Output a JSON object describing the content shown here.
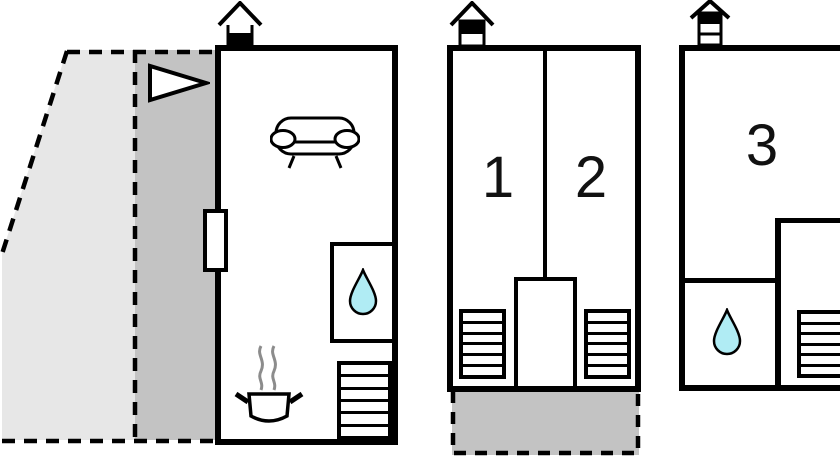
{
  "floor_plan": {
    "room_labels": {
      "bedroom_1": "1",
      "bedroom_2": "2",
      "bedroom_3": "3"
    },
    "colors": {
      "background": "#ffffff",
      "walls": "#000000",
      "garden_light_gray": "#e7e7e7",
      "terrace_gray": "#c3c3c3",
      "water_drop": "#b0ecf4",
      "steam_gray": "#8c8c8c"
    },
    "icons": {
      "chimney": "chimney-icon (house roof with fireplace block), one above each unit",
      "entrance_arrow": "right-pointing triangle entrance arrow",
      "sofa": "sofa-icon marking living room",
      "water_drop": "water-drop-icon marking bathroom/shower",
      "cooking_pot": "steaming-pot-icon marking kitchen",
      "stairs": "striped rectangle stairs symbol",
      "door": "door-opening symbol on left wall"
    }
  }
}
